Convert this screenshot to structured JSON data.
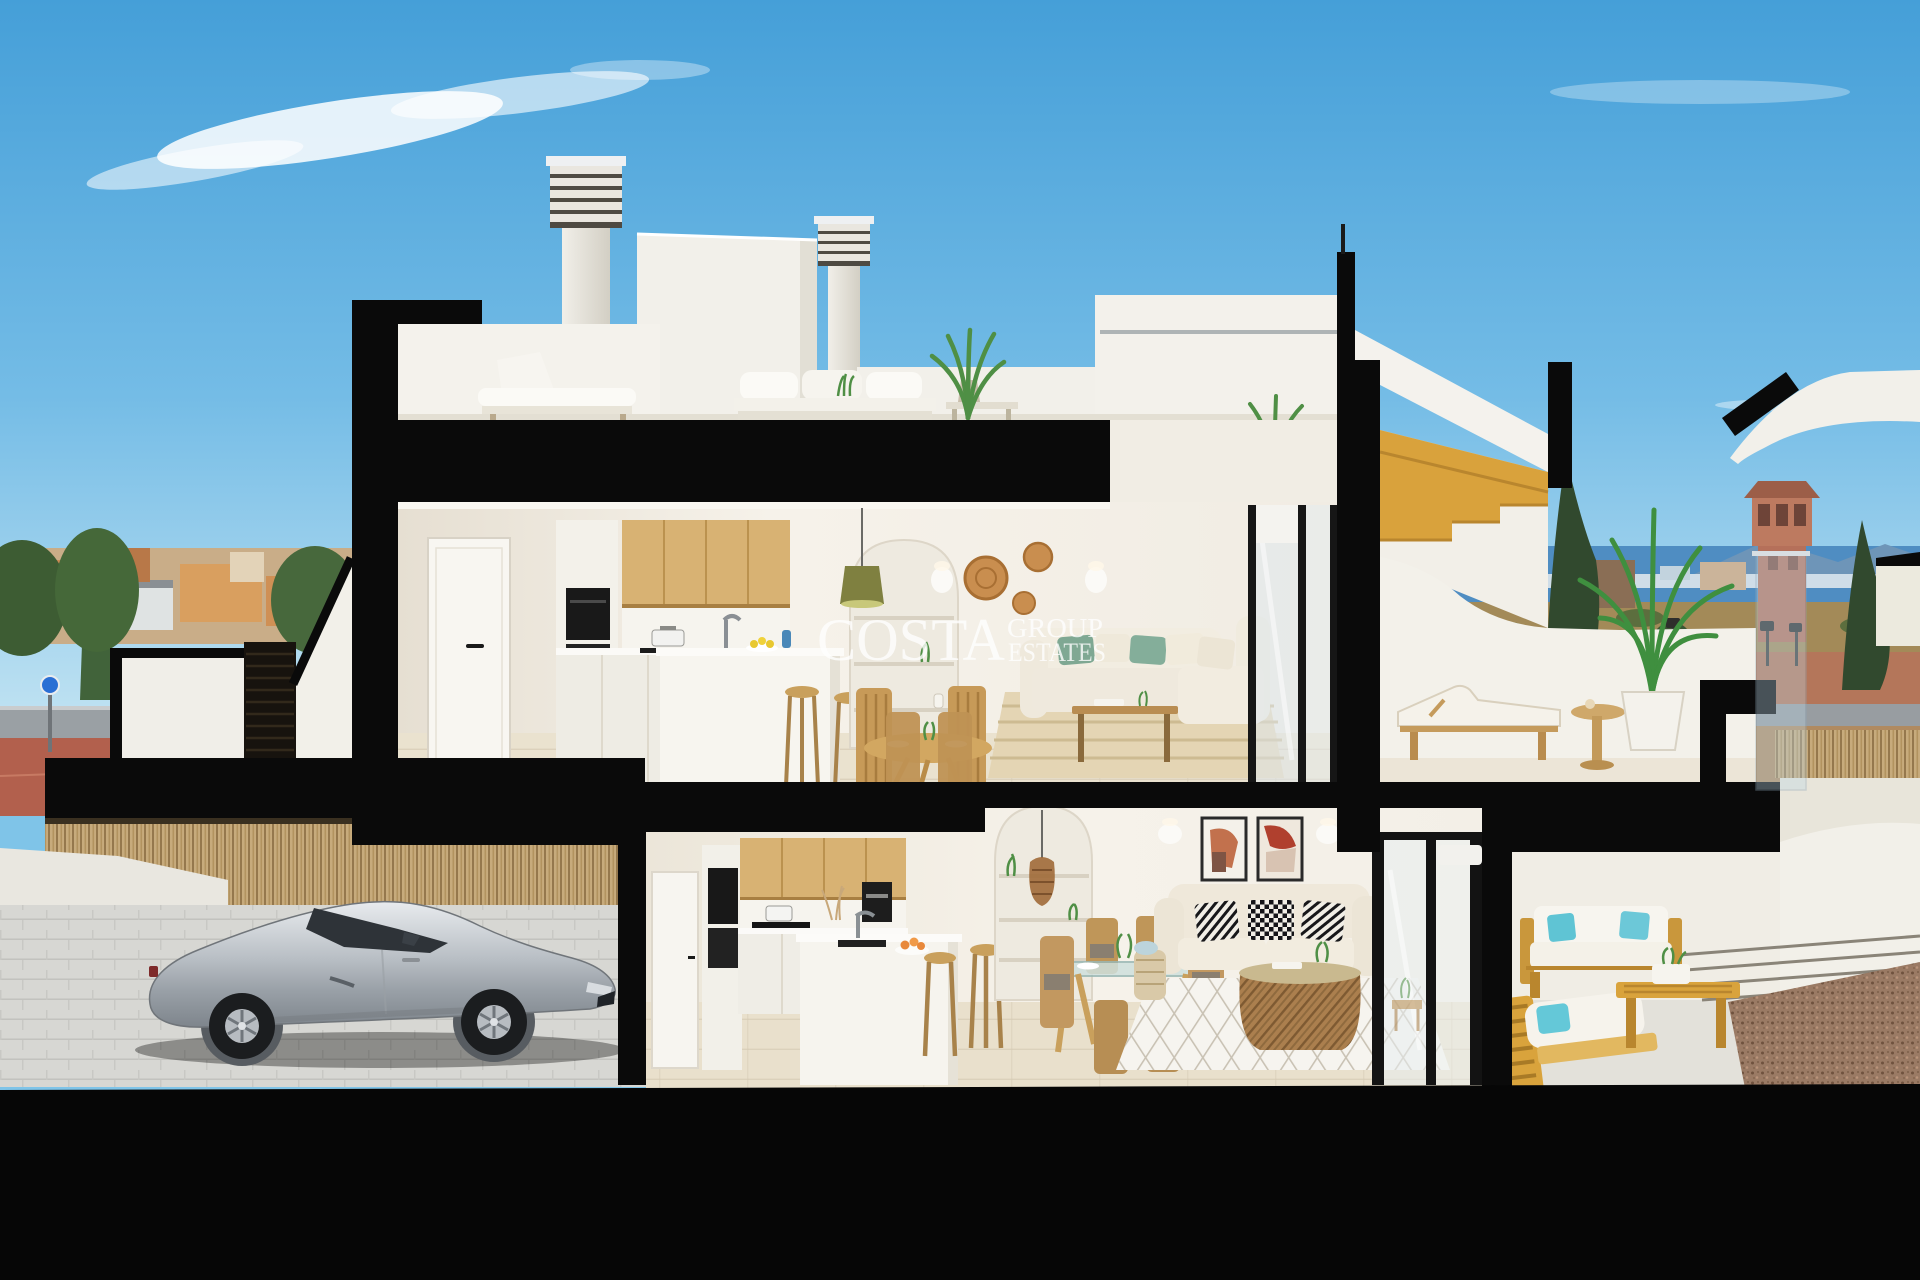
{
  "scene": {
    "kind": "architectural cross-section render",
    "subject": "two-storey coastal townhouse cutaway with roof terrace, furnished interiors, garage with silver sports car, terraces and seaside town backdrop"
  },
  "watermark": {
    "line1": "COSTA",
    "line2": "GROUP",
    "line3": "ESTATES"
  },
  "palette": {
    "sky_top": "#4fa8dd",
    "sky_horizon": "#bce0f2",
    "section_cut_black": "#0a0a0a",
    "wall_white": "#f3f0e9",
    "wood_cabinet": "#d8b273",
    "stair_wood": "#d9a23c",
    "floor_beige": "#eae2cf",
    "sea_blue": "#4f8dc2",
    "red_pavement": "#b2604d",
    "bamboo_fence": "#c7ab7c",
    "car_silver": "#c8ccd0",
    "cushion_green": "#7fa893",
    "pillow_teal": "#5fc4d4",
    "gravel_brown": "#9a7a64",
    "tower_terracotta": "#b5705a"
  }
}
